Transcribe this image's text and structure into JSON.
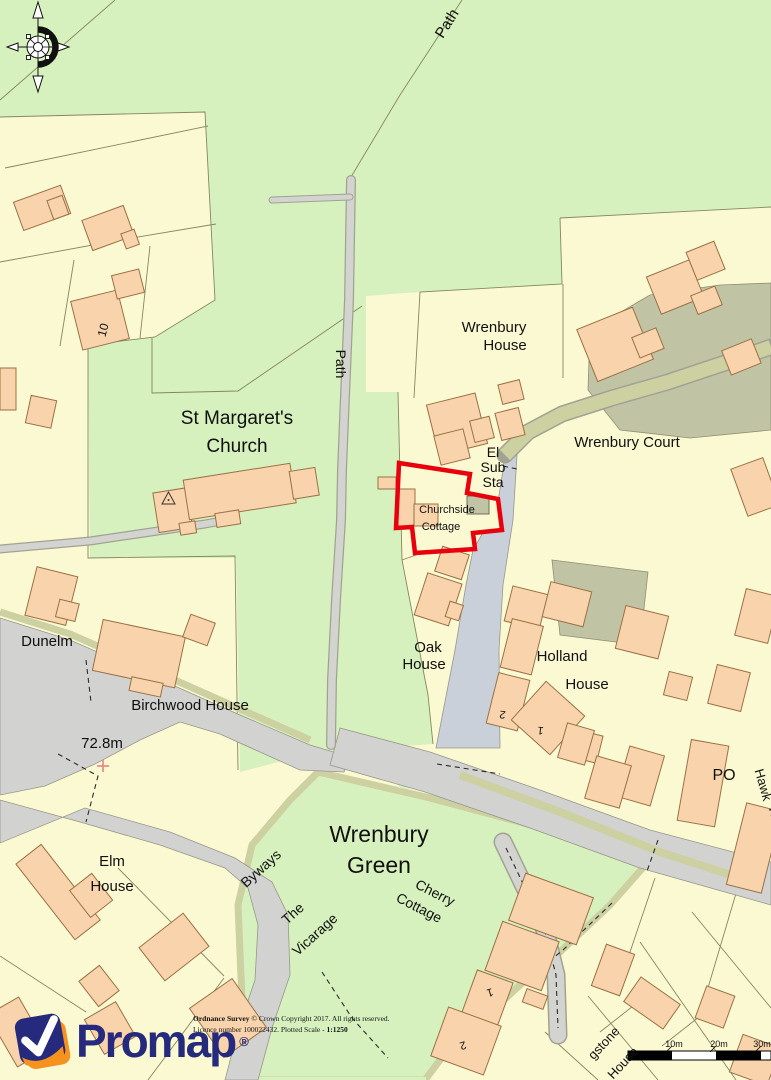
{
  "map": {
    "colors": {
      "green": "#d6f1bd",
      "cream": "#fbf9d2",
      "building": "#f8d3ab",
      "bstroke": "#9a7146",
      "road": "#d2d2d0",
      "roadblue": "#cad0da",
      "verge": "#cdd0a0",
      "court": "#c0c4a4",
      "red": "#e8000d",
      "line": "#85875f",
      "navy": "#252a7d",
      "orange": "#f6921e"
    },
    "subject_property": "Churchside Cottage",
    "labels": [
      {
        "id": "path-top",
        "text": "Path",
        "x": 451,
        "y": 26,
        "size": 15,
        "rotate": -58
      },
      {
        "id": "path-side",
        "text": "Path",
        "x": 336,
        "y": 364,
        "size": 14,
        "rotate": 90
      },
      {
        "id": "st-margarets-1",
        "text": "St Margaret's",
        "x": 237,
        "y": 424,
        "size": 19
      },
      {
        "id": "st-margarets-2",
        "text": "Church",
        "x": 237,
        "y": 452,
        "size": 19
      },
      {
        "id": "wrenbury-house-1",
        "text": "Wrenbury",
        "x": 494,
        "y": 332,
        "size": 15
      },
      {
        "id": "wrenbury-house-2",
        "text": "House",
        "x": 505,
        "y": 350,
        "size": 15
      },
      {
        "id": "el-sub-sta-1",
        "text": "El",
        "x": 493,
        "y": 457,
        "size": 14
      },
      {
        "id": "el-sub-sta-2",
        "text": "Sub",
        "x": 493,
        "y": 472,
        "size": 14
      },
      {
        "id": "el-sub-sta-3",
        "text": "Sta",
        "x": 493,
        "y": 487,
        "size": 14
      },
      {
        "id": "wrenbury-court",
        "text": "Wrenbury Court",
        "x": 627,
        "y": 447,
        "size": 15
      },
      {
        "id": "churchside-1",
        "text": "Churchside",
        "x": 447,
        "y": 513,
        "size": 11
      },
      {
        "id": "churchside-2",
        "text": "Cottage",
        "x": 441,
        "y": 530,
        "size": 11
      },
      {
        "id": "oak-house-1",
        "text": "Oak",
        "x": 428,
        "y": 652,
        "size": 15
      },
      {
        "id": "oak-house-2",
        "text": "House",
        "x": 424,
        "y": 669,
        "size": 15
      },
      {
        "id": "holland-1",
        "text": "Holland",
        "x": 562,
        "y": 661,
        "size": 15
      },
      {
        "id": "holland-2",
        "text": "House",
        "x": 587,
        "y": 689,
        "size": 15
      },
      {
        "id": "dunelm",
        "text": "Dunelm",
        "x": 47,
        "y": 646,
        "size": 15
      },
      {
        "id": "birchwood",
        "text": "Birchwood House",
        "x": 190,
        "y": 710,
        "size": 15
      },
      {
        "id": "spot-height",
        "text": "72.8m",
        "x": 102,
        "y": 748,
        "size": 15
      },
      {
        "id": "wrenbury-green-1",
        "text": "Wrenbury",
        "x": 379,
        "y": 842,
        "size": 23
      },
      {
        "id": "wrenbury-green-2",
        "text": "Green",
        "x": 379,
        "y": 873,
        "size": 23
      },
      {
        "id": "elm-1",
        "text": "Elm",
        "x": 112,
        "y": 866,
        "size": 15
      },
      {
        "id": "elm-2",
        "text": "House",
        "x": 112,
        "y": 891,
        "size": 15
      },
      {
        "id": "byways",
        "text": "Byways",
        "x": 264,
        "y": 872,
        "size": 14,
        "rotate": -42
      },
      {
        "id": "vicarage-1",
        "text": "The",
        "x": 296,
        "y": 917,
        "size": 14,
        "rotate": -42
      },
      {
        "id": "vicarage-2",
        "text": "Vicarage",
        "x": 318,
        "y": 938,
        "size": 14,
        "rotate": -42
      },
      {
        "id": "cherry-1",
        "text": "Cherry",
        "x": 433,
        "y": 897,
        "size": 14,
        "rotate": 27
      },
      {
        "id": "cherry-2",
        "text": "Cottage",
        "x": 417,
        "y": 912,
        "size": 14,
        "rotate": 27
      },
      {
        "id": "po",
        "text": "PO",
        "x": 724,
        "y": 780,
        "size": 16
      },
      {
        "id": "hawk-1",
        "text": "Hawk",
        "x": 759,
        "y": 786,
        "size": 13,
        "rotate": 74
      },
      {
        "id": "hawk-2",
        "text": "Hou",
        "x": 772,
        "y": 820,
        "size": 13,
        "rotate": 74
      },
      {
        "id": "num-10",
        "text": "10",
        "x": 107,
        "y": 331,
        "size": 12,
        "rotate": -75
      },
      {
        "id": "num-2a",
        "text": "2",
        "x": 503,
        "y": 711,
        "size": 11,
        "rotate": 187
      },
      {
        "id": "num-1a",
        "text": "1",
        "x": 541,
        "y": 727,
        "size": 11,
        "rotate": 187
      },
      {
        "id": "num-1b",
        "text": "1",
        "x": 489,
        "y": 989,
        "size": 11,
        "rotate": 163
      },
      {
        "id": "num-2b",
        "text": "2",
        "x": 462,
        "y": 1042,
        "size": 11,
        "rotate": 163
      },
      {
        "id": "gstone-1",
        "text": "gstone",
        "x": 607,
        "y": 1046,
        "size": 13,
        "rotate": -47
      },
      {
        "id": "gstone-2",
        "text": "House",
        "x": 626,
        "y": 1066,
        "size": 13,
        "rotate": -47
      },
      {
        "id": "scale-10m",
        "text": "10m",
        "x": 674,
        "y": 1047,
        "size": 9
      },
      {
        "id": "scale-20m",
        "text": "719",
        "y": 0,
        "size": 9
      },
      {
        "id": "scale-30m",
        "text": "30m",
        "x": 762,
        "y": 1047,
        "size": 9
      }
    ]
  },
  "attribution": {
    "os_bold": "Ordnance Survey",
    "os_rest": "© Crown Copyright 2017. All rights reserved.",
    "licence": "Licence number 100022432. Plotted Scale -",
    "scale": "1:1250"
  },
  "logo": {
    "name": "Promap",
    "registered": "®"
  }
}
